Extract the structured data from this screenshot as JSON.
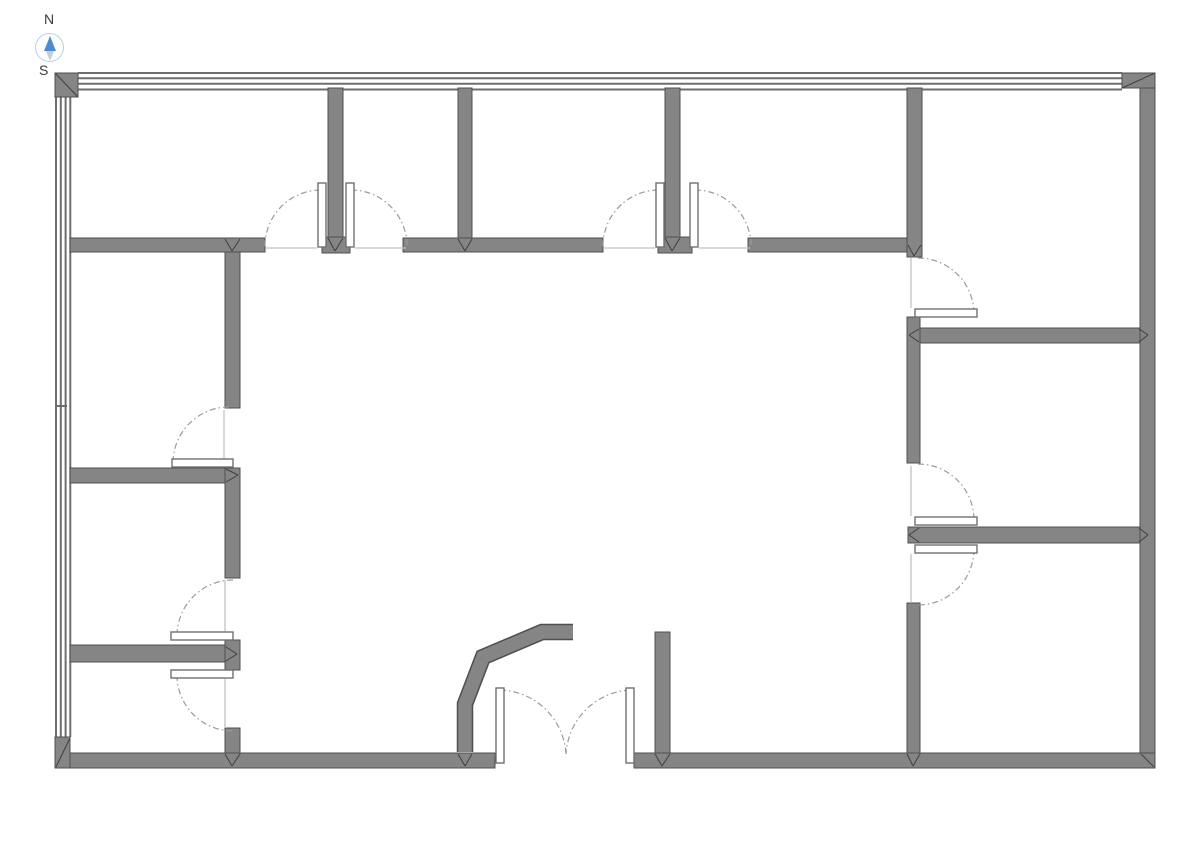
{
  "title": "Office floor plan",
  "compass": {
    "north_label": "N",
    "south_label": "S",
    "ring_color": "#b7d3e8",
    "north_arrow_color": "#4a8cce",
    "south_arrow_color": "#c9ccd0",
    "label_color": "#3a3a3a"
  },
  "plan": {
    "canvas": {
      "w": 1191,
      "h": 842,
      "bg": "#ffffff"
    },
    "colors": {
      "wall_fill": "#858585",
      "wall_stroke": "#4f4f4f",
      "window_line": "#6e6e6e",
      "arc": "#9b9b9b",
      "leaf_fill": "#ffffff",
      "leaf_stroke": "#707070",
      "closed_line": "#c2c2c2",
      "miter": "#3f3f3f"
    },
    "windows": [
      {
        "name": "north-window-wall",
        "band": [
          78,
          72,
          1044,
          19
        ],
        "orientation": "h",
        "line_offsets": [
          73,
          78.3,
          83.7,
          89.5
        ],
        "from": 78,
        "to": 1122
      },
      {
        "name": "west-window-wall",
        "band": [
          55,
          97,
          16,
          640
        ],
        "orientation": "v",
        "line_offsets": [
          56,
          60.8,
          65.6,
          70.3
        ],
        "from": 97,
        "to": 737
      }
    ],
    "window_tick": [
      55,
      406,
      67,
      406
    ],
    "walls": [
      [
        328,
        88,
        15,
        149
      ],
      [
        458,
        88,
        14,
        152
      ],
      [
        665,
        88,
        15,
        149
      ],
      [
        907,
        88,
        15,
        169
      ],
      [
        322,
        237,
        28,
        16
      ],
      [
        658,
        237,
        34,
        16
      ],
      [
        70,
        238,
        195,
        14
      ],
      [
        403,
        238,
        200,
        14
      ],
      [
        748,
        238,
        159,
        14
      ],
      [
        908,
        328,
        232,
        15
      ],
      [
        907,
        317,
        13,
        146
      ],
      [
        908,
        527,
        232,
        16
      ],
      [
        907,
        603,
        13,
        150
      ],
      [
        225,
        252,
        15,
        156
      ],
      [
        70,
        468,
        170,
        15
      ],
      [
        225,
        468,
        15,
        110
      ],
      [
        70,
        645,
        155,
        17
      ],
      [
        225,
        640,
        15,
        30
      ],
      [
        225,
        728,
        15,
        25
      ],
      [
        655,
        632,
        15,
        121
      ],
      [
        1140,
        73,
        15,
        695
      ],
      [
        56,
        753,
        439,
        15
      ],
      [
        634,
        753,
        521,
        15
      ]
    ],
    "angled_wall": {
      "points": [
        [
          573,
          632
        ],
        [
          542,
          632
        ],
        [
          483,
          657
        ],
        [
          465,
          704
        ],
        [
          465,
          752
        ]
      ],
      "outer_width": 16.5,
      "inner_width": 13.5
    },
    "corner_blocks": [
      {
        "rect": [
          55,
          73,
          23,
          24
        ],
        "diag": [
          55.5,
          73.5,
          77.5,
          96.5
        ]
      },
      {
        "rect": [
          1122,
          73,
          33,
          15
        ],
        "diag": [
          1122,
          88,
          1154,
          73.5
        ]
      },
      {
        "rect": [
          55,
          737,
          15,
          31
        ],
        "diag": [
          56,
          767,
          70,
          738
        ]
      },
      {
        "rect": null,
        "diag": [
          1141,
          754,
          1154,
          767
        ]
      }
    ],
    "miter_lines": [
      [
        328,
        238,
        335,
        251
      ],
      [
        343,
        238,
        335,
        251
      ],
      [
        665,
        238,
        672,
        251
      ],
      [
        680,
        238,
        672,
        251
      ],
      [
        458,
        239,
        465,
        251
      ],
      [
        472,
        239,
        465,
        251
      ],
      [
        225,
        239,
        232,
        251
      ],
      [
        240,
        239,
        232,
        251
      ],
      [
        908,
        245,
        914,
        256
      ],
      [
        921,
        245,
        914,
        256
      ],
      [
        226,
        469,
        238,
        475
      ],
      [
        226,
        482,
        238,
        475
      ],
      [
        226,
        647,
        237,
        654
      ],
      [
        226,
        661,
        237,
        654
      ],
      [
        225,
        754,
        232,
        766
      ],
      [
        240,
        754,
        232,
        766
      ],
      [
        458,
        754,
        465,
        766
      ],
      [
        472,
        754,
        465,
        766
      ],
      [
        655,
        754,
        662,
        766
      ],
      [
        670,
        754,
        662,
        766
      ],
      [
        907,
        754,
        913,
        766
      ],
      [
        920,
        754,
        913,
        766
      ],
      [
        919,
        329,
        909,
        335
      ],
      [
        919,
        342,
        909,
        335
      ],
      [
        1139,
        329,
        1148,
        335
      ],
      [
        1139,
        342,
        1148,
        335
      ],
      [
        919,
        528,
        909,
        535
      ],
      [
        919,
        542,
        909,
        535
      ],
      [
        1139,
        528,
        1148,
        535
      ],
      [
        1139,
        542,
        1148,
        535
      ]
    ],
    "door_arcs": [
      "M 265 246 A 56 56 0 0 1 321 190",
      "M 351 190 A 56 56 0 0 1 407 246",
      "M 603 246 A 56 56 0 0 1 659 190",
      "M 695 190 A 56 56 0 0 1 751 246",
      "M 918 258 A 56 56 0 0 1 974 314",
      "M 918 464 A 56 56 0 0 1 974 520",
      "M 974 549 A 56 56 0 0 1 918 605",
      "M 229 407 A 56 56 0 0 0 173 463",
      "M 233 580 A 56 56 0 0 0 177 636",
      "M 177 675 A 56 56 0 0 0 233 731",
      "M 500 690 A 68 68 0 0 1 566 754",
      "M 630 690 A 68 68 0 0 0 566 754"
    ],
    "closed_door_lines": [
      [
        224,
        410,
        224,
        459
      ],
      [
        225,
        580,
        225,
        631
      ],
      [
        225,
        679,
        225,
        728
      ],
      [
        911,
        258,
        911,
        308
      ],
      [
        911,
        466,
        911,
        516
      ],
      [
        911,
        554,
        911,
        603
      ],
      [
        266,
        248,
        317,
        248
      ],
      [
        355,
        248,
        406,
        248
      ],
      [
        604,
        248,
        655,
        248
      ],
      [
        699,
        248,
        750,
        248
      ]
    ],
    "door_leaves": [
      [
        318,
        183,
        8,
        64
      ],
      [
        346,
        183,
        8,
        64
      ],
      [
        656,
        183,
        8,
        64
      ],
      [
        690,
        183,
        8,
        64
      ],
      [
        915,
        309,
        62,
        8
      ],
      [
        915,
        517,
        62,
        8
      ],
      [
        915,
        545,
        62,
        8
      ],
      [
        172,
        459,
        61,
        8
      ],
      [
        171,
        632,
        62,
        8
      ],
      [
        171,
        670,
        62,
        8
      ],
      [
        496,
        688,
        8,
        75
      ],
      [
        626,
        688,
        8,
        75
      ]
    ]
  }
}
